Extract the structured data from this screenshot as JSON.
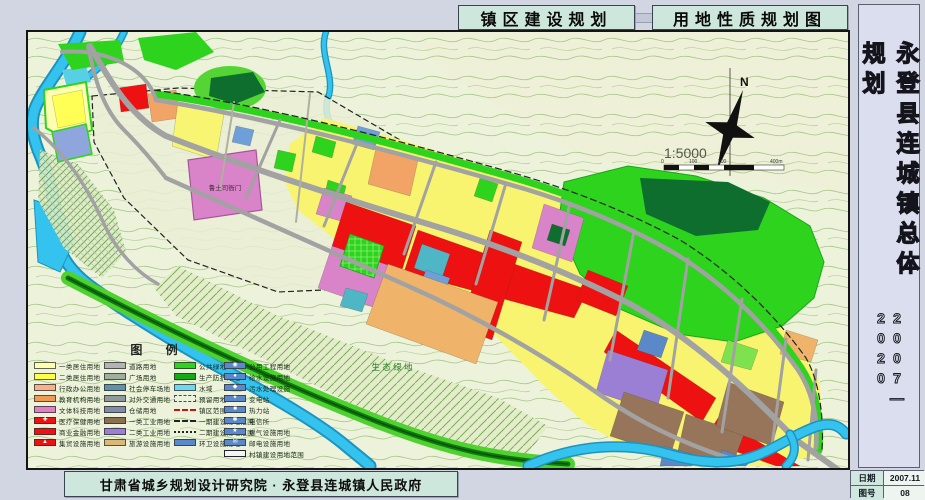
{
  "header": {
    "tabs": [
      {
        "label": "镇区建设规划"
      },
      {
        "label": "用地性质规划图"
      }
    ]
  },
  "sidebar": {
    "title_vertical": "永登县连城镇总体规划",
    "years": "2007—2020"
  },
  "info_table": {
    "rows": [
      {
        "label": "日期",
        "value": "2007.11"
      },
      {
        "label": "图号",
        "value": "08"
      }
    ]
  },
  "footer": {
    "credit": "甘肃省城乡规划设计研究院 · 永登县连城镇人民政府"
  },
  "map": {
    "labels": {
      "historic_site": "鲁土司衙门",
      "eco_green": "生 态 绿 地",
      "compass_n": "N",
      "scale_ratio": "1:5000"
    },
    "scale_ticks": [
      "0",
      "100",
      "200",
      "400m"
    ],
    "legend": {
      "title": "图  例",
      "columns": [
        {
          "items": [
            {
              "label": "一类居住用地",
              "color": "#ffffae",
              "type": "swatch"
            },
            {
              "label": "二类居住用地",
              "color": "#ffff4b",
              "type": "swatch"
            },
            {
              "label": "行政办公用地",
              "color": "#f6b08a",
              "type": "swatch"
            },
            {
              "label": "教育机构用地",
              "color": "#f09a58",
              "type": "swatch"
            },
            {
              "label": "文体科技用地",
              "color": "#e07fc3",
              "type": "swatch"
            },
            {
              "label": "医疗保健用地",
              "color": "#ee1111",
              "type": "swatch-icon",
              "icon": "✚",
              "icon_name": "medical-cross"
            },
            {
              "label": "商业金融用地",
              "color": "#ee1111",
              "type": "swatch"
            },
            {
              "label": "集贸设施用地",
              "color": "#ee1111",
              "type": "swatch-icon",
              "icon": "▲",
              "icon_name": "market-triangle"
            }
          ]
        },
        {
          "items": [
            {
              "label": "道路用地",
              "color": "#b3b3b3",
              "type": "swatch"
            },
            {
              "label": "广场用地",
              "color": "#9fae9f",
              "type": "swatch"
            },
            {
              "label": "社会停车场地",
              "color": "#5f93a8",
              "type": "swatch"
            },
            {
              "label": "对外交通用地",
              "color": "#8f9a9a",
              "type": "swatch"
            },
            {
              "label": "仓储用地",
              "color": "#7f8ea2",
              "type": "swatch"
            },
            {
              "label": "一类工业用地",
              "color": "#8a6f52",
              "type": "swatch"
            },
            {
              "label": "二类工业用地",
              "color": "#9b7fd4",
              "type": "swatch"
            },
            {
              "label": "旅游设施用地",
              "color": "#dcb878",
              "type": "swatch"
            }
          ]
        },
        {
          "items": [
            {
              "label": "公共绿地",
              "color": "#2ed31e",
              "type": "swatch"
            },
            {
              "label": "生产防护绿地",
              "color": "#17a817",
              "type": "swatch"
            },
            {
              "label": "水域",
              "color": "#6fd8f0",
              "type": "swatch"
            },
            {
              "label": "预留用地",
              "color": "#e8f4e0",
              "type": "outline"
            },
            {
              "label": "镇区范围",
              "type": "dash-red"
            },
            {
              "label": "一期建设用地范围",
              "type": "dash-black"
            },
            {
              "label": "二期建设用地范围",
              "type": "dashdot-black"
            },
            {
              "label": "环卫设施用地",
              "color": "#5b88c8",
              "type": "swatch"
            }
          ]
        },
        {
          "items": [
            {
              "label": "公用工程用地",
              "color": "#5b88c8",
              "type": "swatch-icon",
              "icon": "◉",
              "icon_name": "utility"
            },
            {
              "label": "给水设施用地",
              "color": "#5b88c8",
              "type": "swatch-icon",
              "icon": "●",
              "icon_name": "water-supply"
            },
            {
              "label": "污水处理设施",
              "color": "#5b88c8",
              "type": "swatch-icon",
              "icon": "◆",
              "icon_name": "sewage"
            },
            {
              "label": "变电站",
              "color": "#5b88c8",
              "type": "swatch-icon",
              "icon": "✦",
              "icon_name": "substation"
            },
            {
              "label": "热力站",
              "color": "#5b88c8",
              "type": "swatch-icon",
              "icon": "■",
              "icon_name": "heating"
            },
            {
              "label": "电信所",
              "color": "#5b88c8",
              "type": "swatch-icon",
              "icon": "✱",
              "icon_name": "telecom"
            },
            {
              "label": "燃气设施用地",
              "color": "#5b88c8",
              "type": "swatch-icon",
              "icon": "★",
              "icon_name": "gas"
            },
            {
              "label": "邮电设施用地",
              "color": "#5b88c8",
              "type": "swatch-icon",
              "icon": "✉",
              "icon_name": "post"
            },
            {
              "label": "村镇建设用地范围",
              "color": "#f2f4ee",
              "type": "outline-solid"
            }
          ]
        }
      ]
    }
  },
  "colors": {
    "page_bg": "#d2d6e2",
    "title_box_bg": "#cde7dc",
    "map_bg": "#edf2db",
    "contour_line": "#a5c687",
    "river": "#33c3ee",
    "residential_yellow": "#f8f470",
    "commercial_red": "#ee1111",
    "culture_pink": "#d983c9",
    "education_orange": "#efb36a",
    "industry_brown": "#96755a",
    "industry_purple": "#9b7fd4",
    "utility_blue": "#5b88c8",
    "green_space": "#2ed31e",
    "dark_forest": "#0e6e2e",
    "road_gray": "#a2a2a2",
    "sidebar_bg": "#dbdeee"
  }
}
